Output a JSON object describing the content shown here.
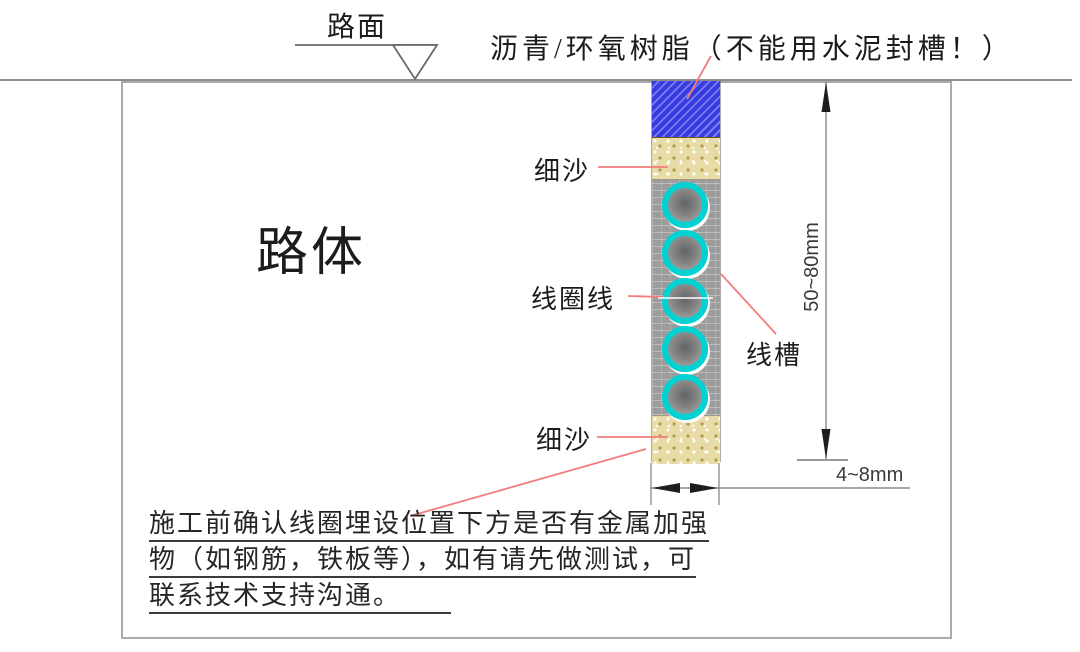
{
  "labels": {
    "road_surface": "路面",
    "seal_note": "沥青/环氧树脂（不能用水泥封槽！）",
    "fine_sand_top": "细沙",
    "coil_wire": "线圈线",
    "slot": "线槽",
    "fine_sand_bottom": "细沙",
    "road_body": "路体"
  },
  "dimensions": {
    "slot_depth": "50~80mm",
    "slot_width": "4~8mm"
  },
  "note": {
    "line1": "施工前确认线圈埋设位置下方是否有金属加强",
    "line2": "物（如钢筋，铁板等），如有请先做测试，可",
    "line3": "联系技术支持沟通。"
  },
  "materials": {
    "seal_color": "#383ce0",
    "sand_color": "#e7dba6",
    "slot_gray": "#9c9c9c",
    "coil_ring_color": "#00d2d2",
    "leader_red": "#f37c7c",
    "line_gray": "#8c8c8c"
  },
  "coil": {
    "count": 5
  }
}
